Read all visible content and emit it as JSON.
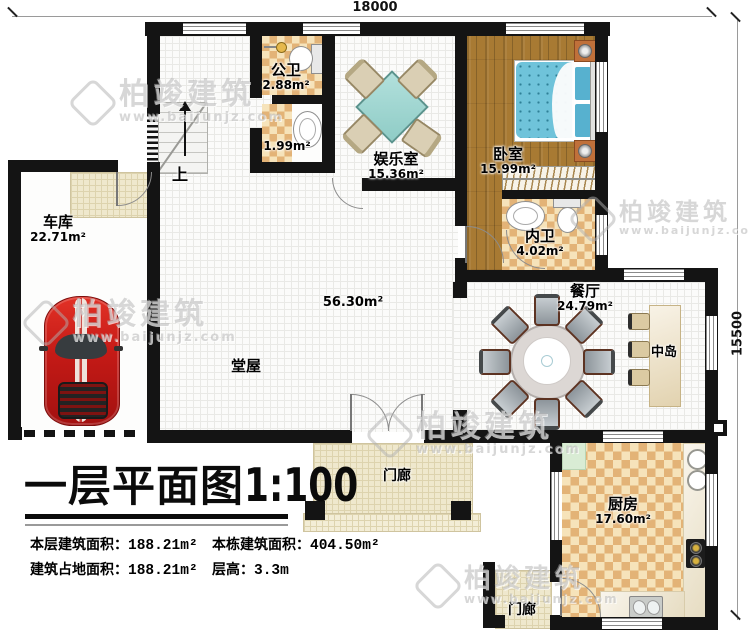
{
  "title": {
    "main": "一层平面图",
    "scale": "1:100"
  },
  "dimensions": {
    "width_mm": "18000",
    "height_mm": "15500"
  },
  "rooms": {
    "garage": {
      "label": "车库",
      "area": "22.71m²"
    },
    "public_bath": {
      "label": "公卫",
      "area": "2.88m²"
    },
    "wash_room": {
      "area": "1.99m²"
    },
    "entertainment_room": {
      "label": "娱乐室",
      "area": "15.36m²"
    },
    "bedroom": {
      "label": "卧室",
      "area": "15.99m²"
    },
    "inner_bath": {
      "label": "内卫",
      "area": "4.02m²"
    },
    "dining_room": {
      "label": "餐厅",
      "area": "24.79m²"
    },
    "center_island": {
      "label": "中岛"
    },
    "main_hall": {
      "label": "堂屋",
      "area": "56.30m²"
    },
    "kitchen": {
      "label": "厨房",
      "area": "17.60m²"
    },
    "front_porch": {
      "label": "门廊"
    },
    "back_porch": {
      "label": "门廊"
    },
    "stairs": {
      "label": "上"
    }
  },
  "info_table": {
    "floor_area": {
      "label": "本层建筑面积：",
      "value": "188.21m²"
    },
    "total_area": {
      "label": "本栋建筑面积：",
      "value": "404.50m²"
    },
    "footprint_area": {
      "label": "建筑占地面积：",
      "value": "188.21m²"
    },
    "floor_height": {
      "label": "层高：",
      "value": "3.3m"
    }
  },
  "watermark": {
    "brand": "柏竣建筑",
    "url": "www.baijunjz.com"
  },
  "colors": {
    "wall": "#141414",
    "tile_dark": "#e3b377",
    "tile_light": "#f6e3ba",
    "wood": "#a87a33",
    "car_red": "#c41a16",
    "table_teal": "#9fd8d2"
  }
}
